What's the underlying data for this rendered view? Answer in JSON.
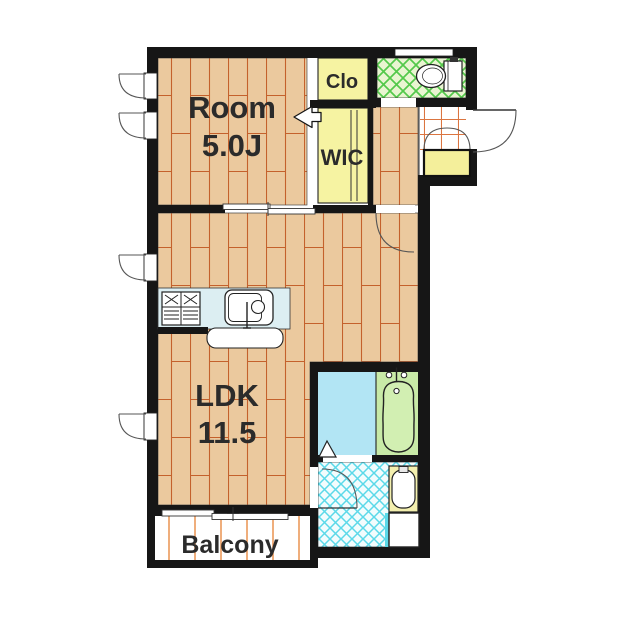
{
  "plan": {
    "rooms": {
      "bedroom": {
        "name": "Room",
        "size": "5.0J"
      },
      "ldk": {
        "name": "LDK",
        "size": "11.5"
      },
      "closet": {
        "label": "Clo"
      },
      "walk_in_closet": {
        "label": "WIC"
      },
      "balcony": {
        "label": "Balcony"
      }
    },
    "fixtures": [
      "toilet-icon",
      "bathtub-icon",
      "washbasin-icon",
      "washing-machine-icon",
      "gas-stove-icon",
      "kitchen-sink-icon",
      "kitchen-counter",
      "shoe-cabinet"
    ],
    "colors": {
      "wall": "#161616",
      "wood_floor": "#ebc99e",
      "plank_line": "#c4612c",
      "closet_yellow": "#f6f3a2",
      "toilet_bg": "#e9f5d1",
      "toilet_lattice": "#54c94b",
      "bathroom_blue": "#b2e5f4",
      "bathtub_green": "#c8eaa7",
      "washroom_lattice": "#5bd9e9",
      "counter_blue": "#dceef2",
      "balcony_line": "#eb9a5c",
      "entry_tile_line": "#db7540"
    }
  }
}
